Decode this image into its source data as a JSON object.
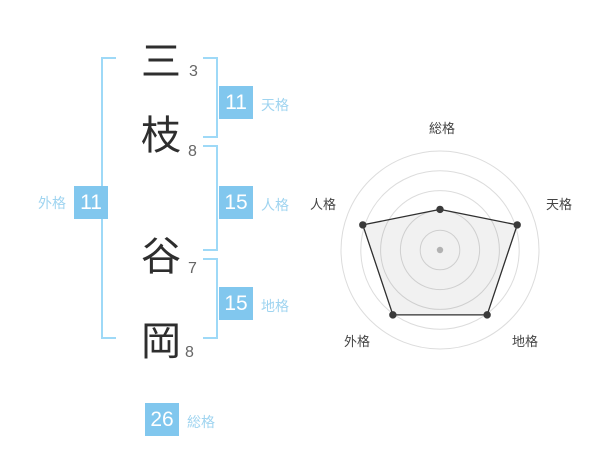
{
  "page": {
    "background": "#ffffff"
  },
  "name_diagram": {
    "surname": [
      {
        "char": "三",
        "strokes": "3"
      },
      {
        "char": "枝",
        "strokes": "8"
      }
    ],
    "given_name": [
      {
        "char": "谷",
        "strokes": "7"
      },
      {
        "char": "岡",
        "strokes": "8"
      }
    ],
    "tenkaku": {
      "value": "11",
      "label": "天格"
    },
    "jinkaku": {
      "value": "15",
      "label": "人格"
    },
    "chikaku": {
      "value": "15",
      "label": "地格"
    },
    "gaikaku": {
      "value": "11",
      "label": "外格"
    },
    "soukaku": {
      "value": "26",
      "label": "総格"
    }
  },
  "colors": {
    "badge_blue": "#81c7ee",
    "label_blue": "#9fd4f0",
    "bracket_blue": "#9ed9f7",
    "ring_gray": "#dcdcdc",
    "polygon_stroke": "#2f2f2f",
    "point_dark": "#3a3a3a",
    "center_dot": "#bdbdbd",
    "axis_label": "#444444"
  },
  "chart_data": {
    "type": "radar",
    "categories": [
      "総格",
      "天格",
      "地格",
      "外格",
      "人格"
    ],
    "values_percent": [
      41,
      82,
      81,
      81,
      82
    ],
    "max": 100,
    "rings_percent": [
      20,
      40,
      60,
      80,
      100
    ],
    "grid": "concentric-circles",
    "legend": "none",
    "title": ""
  }
}
